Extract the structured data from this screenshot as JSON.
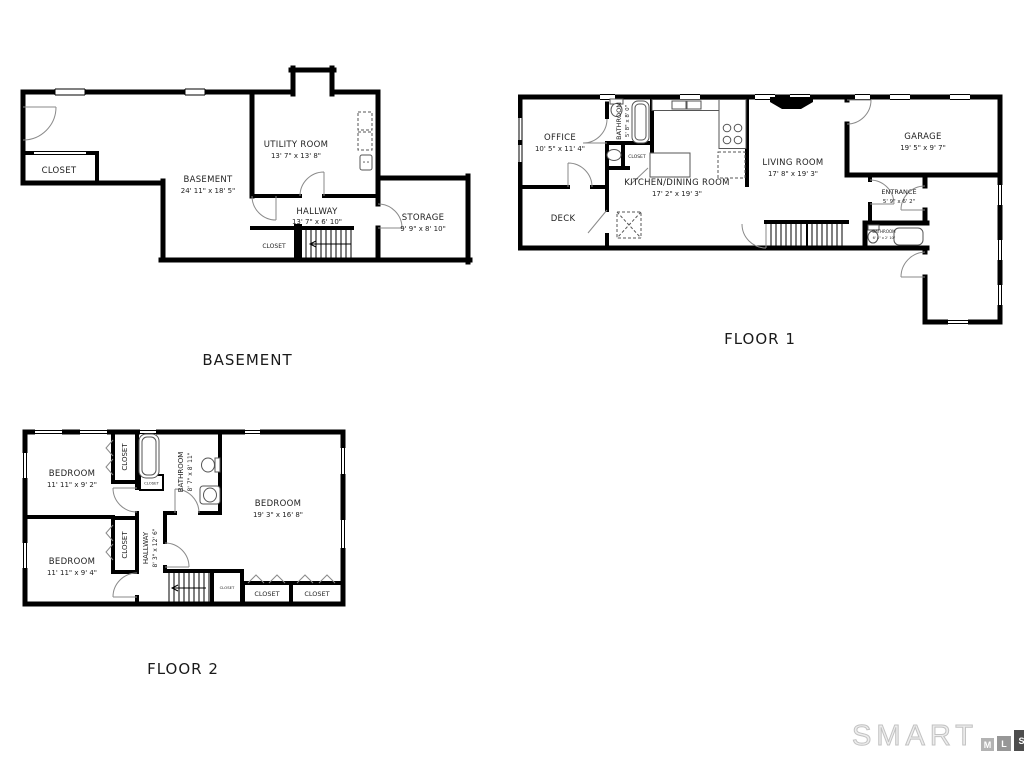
{
  "titles": {
    "basement": "BASEMENT",
    "floor1": "FLOOR 1",
    "floor2": "FLOOR 2"
  },
  "basement": {
    "closet": {
      "name": "CLOSET"
    },
    "main": {
      "name": "BASEMENT",
      "dims": "24' 11\" x 18' 5\""
    },
    "utility": {
      "name": "UTILITY ROOM",
      "dims": "13' 7\" x 13' 8\""
    },
    "hallway": {
      "name": "HALLWAY",
      "dims": "13' 7\" x 6' 10\""
    },
    "closet2": {
      "name": "CLOSET"
    },
    "storage": {
      "name": "STORAGE",
      "dims": "9' 9\" x 8' 10\""
    }
  },
  "floor1": {
    "office": {
      "name": "OFFICE",
      "dims": "10' 5\" x 11' 4\""
    },
    "bathroom_top": {
      "name": "BATHROOM",
      "dims": "5' 8\" x 8' 0\""
    },
    "closet": {
      "name": "CLOSET"
    },
    "deck": {
      "name": "DECK"
    },
    "kitchen": {
      "name": "KITCHEN/DINING ROOM",
      "dims": "17' 2\" x 19' 3\""
    },
    "living": {
      "name": "LIVING ROOM",
      "dims": "17' 8\" x 19' 3\""
    },
    "garage": {
      "name": "GARAGE",
      "dims": "19' 5\" x 9' 7\""
    },
    "entrance": {
      "name": "ENTRANCE",
      "dims": "5' 9\" x 6' 2\""
    },
    "bathroom_small": {
      "name": "BATHROOM",
      "dims": "6' 4\" x 2' 10\""
    }
  },
  "floor2": {
    "bedroom1": {
      "name": "BEDROOM",
      "dims": "11' 11\" x 9' 2\""
    },
    "closet_top": {
      "name": "CLOSET"
    },
    "closet_mid": {
      "name": "CLOSET"
    },
    "bathroom": {
      "name": "BATHROOM",
      "dims": "8' 7\" x 8' 11\""
    },
    "bedroom_big": {
      "name": "BEDROOM",
      "dims": "19' 3\" x 16' 8\""
    },
    "closet_left": {
      "name": "CLOSET"
    },
    "bedroom2": {
      "name": "BEDROOM",
      "dims": "11' 11\" x 9' 4\""
    },
    "hallway": {
      "name": "HALLWAY",
      "dims": "8' 3\" x 12' 6\""
    },
    "closet_stairs": {
      "name": "CLOSET"
    },
    "closet_br1": {
      "name": "CLOSET"
    },
    "closet_br2": {
      "name": "CLOSET"
    }
  },
  "logo": {
    "brand": "SMART",
    "m": "M",
    "l": "L",
    "s": "S"
  },
  "colors": {
    "wall": "#000000",
    "background": "#ffffff",
    "logo_gray": "#c2c2c2"
  }
}
